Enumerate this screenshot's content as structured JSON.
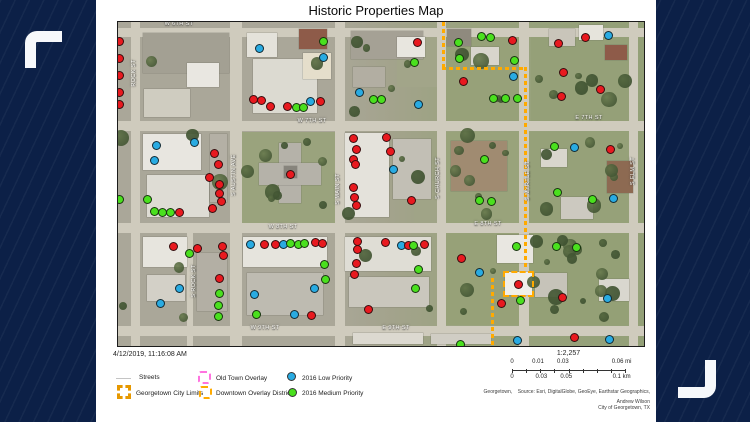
{
  "title": "Historic Properties Map",
  "colors": {
    "background_navy": "#0c2047",
    "bracket_white": "#f6f8fb",
    "panel_white": "#ffffff",
    "dot_red": "#e8191f",
    "dot_green": "#4ae01e",
    "dot_blue": "#29abe2",
    "boundary_orange": "#ffaa00",
    "old_town_pink": "#ff73df",
    "city_limits_orange": "#e69800"
  },
  "map": {
    "street_labels": [
      {
        "text": "W 6TH ST",
        "x": 178,
        "y": 23,
        "v": 0
      },
      {
        "text": "ROCK ST",
        "x": 133,
        "y": 72,
        "v": 1
      },
      {
        "text": "W 7TH ST",
        "x": 311,
        "y": 120,
        "v": 0
      },
      {
        "text": "E 7TH ST",
        "x": 588,
        "y": 117,
        "v": 0
      },
      {
        "text": "S AUSTIN AVE",
        "x": 233,
        "y": 175,
        "v": 1
      },
      {
        "text": "S MAIN ST",
        "x": 337,
        "y": 188,
        "v": 1
      },
      {
        "text": "S CHURCH ST",
        "x": 437,
        "y": 178,
        "v": 1
      },
      {
        "text": "S MYRTLE ST",
        "x": 527,
        "y": 180,
        "v": 1
      },
      {
        "text": "S ELM ST",
        "x": 632,
        "y": 170,
        "v": 1
      },
      {
        "text": "S ROCK ST",
        "x": 193,
        "y": 280,
        "v": 1
      },
      {
        "text": "W 8TH ST",
        "x": 282,
        "y": 226,
        "v": 0
      },
      {
        "text": "E 8TH ST",
        "x": 487,
        "y": 223,
        "v": 0
      },
      {
        "text": "W 9TH ST",
        "x": 264,
        "y": 327,
        "v": 0
      },
      {
        "text": "E 9TH ST",
        "x": 395,
        "y": 327,
        "v": 0
      }
    ],
    "boundary": {
      "color": "#ffaa00",
      "segments": [
        {
          "type": "v",
          "x": 441,
          "y1": 21,
          "y2": 66
        },
        {
          "type": "h",
          "y": 66,
          "x1": 441,
          "x2": 523
        },
        {
          "type": "v",
          "x": 523,
          "y1": 66,
          "y2": 268
        },
        {
          "type": "rect",
          "x": 502,
          "y": 270,
          "w": 31,
          "h": 26
        },
        {
          "type": "v",
          "x": 490,
          "y1": 277,
          "y2": 344
        }
      ]
    },
    "dot_colors": {
      "r": "#e8191f",
      "g": "#4ae01e",
      "b": "#29abe2"
    },
    "dots": [
      [
        118,
        40,
        "r"
      ],
      [
        118,
        57,
        "r"
      ],
      [
        118,
        74,
        "r"
      ],
      [
        118,
        91,
        "r"
      ],
      [
        118,
        103,
        "r"
      ],
      [
        258,
        47,
        "b"
      ],
      [
        322,
        40,
        "g"
      ],
      [
        322,
        56,
        "b"
      ],
      [
        252,
        98,
        "r"
      ],
      [
        260,
        99,
        "r"
      ],
      [
        269,
        105,
        "r"
      ],
      [
        286,
        105,
        "r"
      ],
      [
        295,
        106,
        "g"
      ],
      [
        302,
        106,
        "g"
      ],
      [
        309,
        100,
        "b"
      ],
      [
        319,
        100,
        "r"
      ],
      [
        358,
        91,
        "b"
      ],
      [
        372,
        98,
        "g"
      ],
      [
        380,
        98,
        "g"
      ],
      [
        416,
        41,
        "r"
      ],
      [
        413,
        61,
        "g"
      ],
      [
        457,
        41,
        "g"
      ],
      [
        480,
        35,
        "g"
      ],
      [
        489,
        36,
        "g"
      ],
      [
        511,
        39,
        "r"
      ],
      [
        458,
        57,
        "g"
      ],
      [
        513,
        59,
        "g"
      ],
      [
        512,
        75,
        "b"
      ],
      [
        462,
        80,
        "r"
      ],
      [
        492,
        97,
        "g"
      ],
      [
        504,
        97,
        "g"
      ],
      [
        516,
        97,
        "g"
      ],
      [
        417,
        103,
        "b"
      ],
      [
        557,
        42,
        "r"
      ],
      [
        584,
        36,
        "r"
      ],
      [
        607,
        34,
        "b"
      ],
      [
        562,
        71,
        "r"
      ],
      [
        599,
        88,
        "r"
      ],
      [
        560,
        95,
        "r"
      ],
      [
        118,
        198,
        "g"
      ],
      [
        155,
        144,
        "b"
      ],
      [
        193,
        141,
        "b"
      ],
      [
        153,
        159,
        "b"
      ],
      [
        213,
        152,
        "r"
      ],
      [
        217,
        163,
        "r"
      ],
      [
        208,
        176,
        "r"
      ],
      [
        218,
        183,
        "r"
      ],
      [
        218,
        192,
        "r"
      ],
      [
        220,
        200,
        "r"
      ],
      [
        211,
        207,
        "r"
      ],
      [
        146,
        198,
        "g"
      ],
      [
        153,
        210,
        "g"
      ],
      [
        161,
        211,
        "g"
      ],
      [
        169,
        211,
        "g"
      ],
      [
        178,
        211,
        "r"
      ],
      [
        289,
        173,
        "r"
      ],
      [
        352,
        137,
        "r"
      ],
      [
        355,
        148,
        "r"
      ],
      [
        352,
        158,
        "r"
      ],
      [
        354,
        163,
        "r"
      ],
      [
        352,
        186,
        "r"
      ],
      [
        353,
        196,
        "r"
      ],
      [
        355,
        204,
        "r"
      ],
      [
        385,
        136,
        "r"
      ],
      [
        389,
        150,
        "r"
      ],
      [
        392,
        168,
        "b"
      ],
      [
        410,
        199,
        "r"
      ],
      [
        483,
        158,
        "g"
      ],
      [
        478,
        199,
        "g"
      ],
      [
        490,
        200,
        "g"
      ],
      [
        553,
        145,
        "g"
      ],
      [
        573,
        146,
        "b"
      ],
      [
        609,
        148,
        "r"
      ],
      [
        556,
        191,
        "g"
      ],
      [
        591,
        198,
        "g"
      ],
      [
        612,
        197,
        "b"
      ],
      [
        172,
        245,
        "r"
      ],
      [
        188,
        252,
        "g"
      ],
      [
        196,
        247,
        "r"
      ],
      [
        221,
        245,
        "r"
      ],
      [
        222,
        254,
        "r"
      ],
      [
        218,
        277,
        "r"
      ],
      [
        178,
        287,
        "b"
      ],
      [
        218,
        292,
        "g"
      ],
      [
        159,
        302,
        "b"
      ],
      [
        217,
        304,
        "g"
      ],
      [
        217,
        315,
        "g"
      ],
      [
        249,
        243,
        "b"
      ],
      [
        263,
        243,
        "r"
      ],
      [
        274,
        243,
        "r"
      ],
      [
        282,
        243,
        "b"
      ],
      [
        289,
        242,
        "g"
      ],
      [
        297,
        243,
        "g"
      ],
      [
        303,
        242,
        "g"
      ],
      [
        314,
        241,
        "r"
      ],
      [
        321,
        242,
        "r"
      ],
      [
        323,
        263,
        "g"
      ],
      [
        324,
        278,
        "g"
      ],
      [
        313,
        287,
        "b"
      ],
      [
        253,
        293,
        "b"
      ],
      [
        255,
        313,
        "g"
      ],
      [
        293,
        313,
        "b"
      ],
      [
        310,
        314,
        "r"
      ],
      [
        356,
        240,
        "r"
      ],
      [
        356,
        248,
        "r"
      ],
      [
        355,
        262,
        "r"
      ],
      [
        353,
        273,
        "r"
      ],
      [
        367,
        308,
        "r"
      ],
      [
        384,
        241,
        "r"
      ],
      [
        400,
        244,
        "b"
      ],
      [
        407,
        244,
        "r"
      ],
      [
        412,
        244,
        "g"
      ],
      [
        423,
        243,
        "r"
      ],
      [
        417,
        268,
        "g"
      ],
      [
        414,
        287,
        "g"
      ],
      [
        460,
        257,
        "r"
      ],
      [
        478,
        271,
        "b"
      ],
      [
        515,
        245,
        "g"
      ],
      [
        517,
        283,
        "r"
      ],
      [
        500,
        302,
        "r"
      ],
      [
        519,
        299,
        "g"
      ],
      [
        555,
        245,
        "g"
      ],
      [
        575,
        246,
        "g"
      ],
      [
        561,
        296,
        "r"
      ],
      [
        606,
        297,
        "b"
      ],
      [
        459,
        343,
        "g"
      ],
      [
        516,
        339,
        "b"
      ],
      [
        573,
        336,
        "r"
      ],
      [
        608,
        338,
        "b"
      ]
    ]
  },
  "legend": {
    "timestamp": "4/12/2019, 11:16:08 AM",
    "streets": "Streets",
    "city_limits": "Georgetown City Limits",
    "old_town": "Old Town Overlay",
    "downtown": "Downtown Overlay District",
    "low": "2016 Low Priority",
    "medium": "2016 Medium Priority"
  },
  "scalebar": {
    "ratio": "1:2,257",
    "mi_labels": [
      "0",
      "0.01",
      "0.03",
      "0.06 mi"
    ],
    "mi_pos": [
      0,
      23,
      45,
      97
    ],
    "km_labels": [
      "0",
      "0.03",
      "0.05",
      "0.1 km"
    ],
    "km_pos": [
      0,
      26,
      48,
      97
    ]
  },
  "attribution": {
    "line1": "Georgetown,    Source: Esri, DigitalGlobe, GeoEye, Earthstar Geographics,",
    "line2": "Andrew Wilson",
    "line3": "City of Georgetown, TX"
  }
}
